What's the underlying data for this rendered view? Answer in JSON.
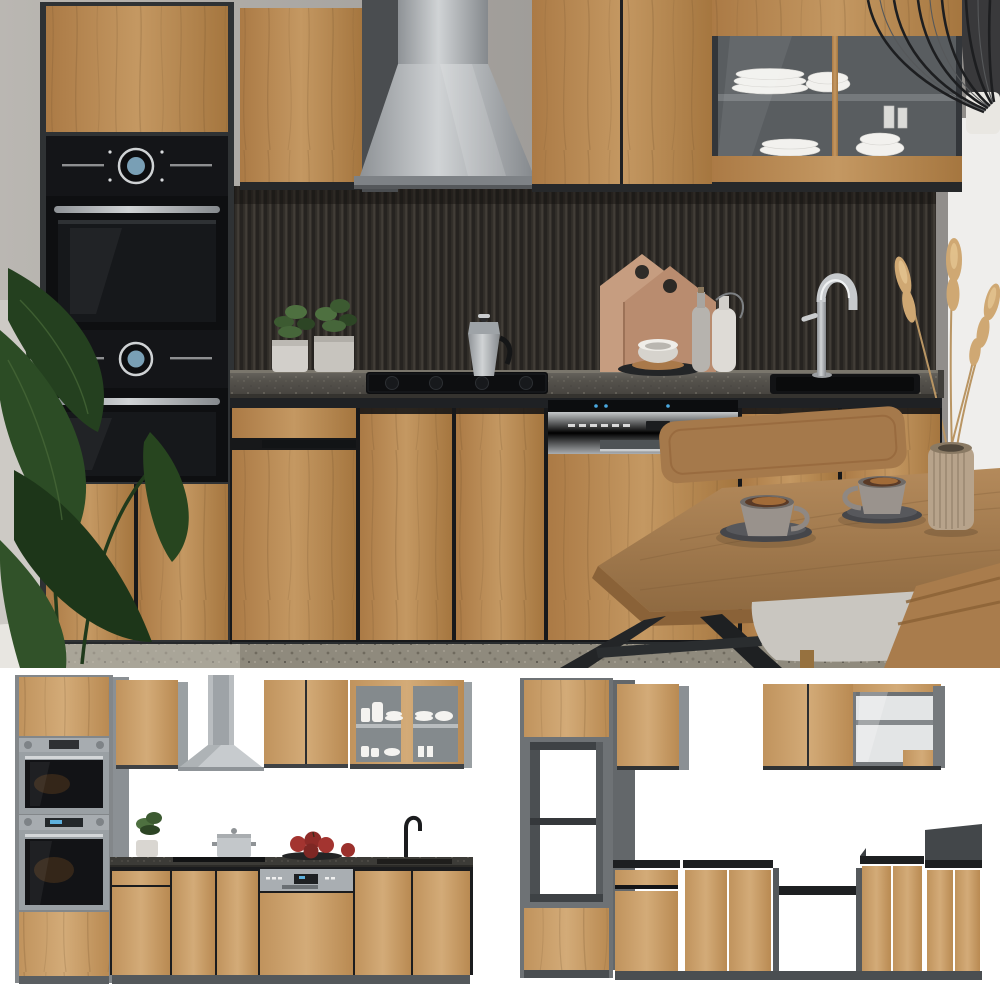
{
  "labels": {
    "page": "Product photo – modern oak and anthracite kitchenette set",
    "main_scene": "Kitchen scene: oak-front kitchenette with anthracite carcass, built-in double oven, chimney hood, glass display cabinet, dark fluted backsplash, sink and dining table",
    "thumb_front": "Front elevation render of the full kitchen set with appliances",
    "thumb_carcass": "Carcass render of the kitchen set without appliances (open niches)",
    "tall_cabinet": "Tall oven housing cabinet with stacked double oven",
    "wall_cabinets": "Oak wall cabinets",
    "range_hood": "Stainless steel chimney range hood",
    "glass_cabinet": "Glass display wall cabinet with white dishes",
    "pendant_lamp": "Black wire cage pendant lamp",
    "backsplash": "Dark fluted backsplash panel",
    "countertop": "Dark stone-effect countertop",
    "cooktop": "Black built-in cooktop with moka pot",
    "herb_pots": "Potted green herbs",
    "cutting_boards": "House-shaped wooden cutting boards",
    "bowl_tray": "Serving tray with bowl",
    "bottles": "Ceramic bottle and jug",
    "sink": "Black inset sink with chrome mixer tap",
    "dishwasher": "Semi-integrated dishwasher with stainless control panel",
    "base_cabinets": "Handleless oak base cabinets on anthracite plinth",
    "houseplant": "Large green houseplant",
    "pampas": "Dried pampas grass in ribbed vase",
    "dining_table": "Oak dining table with black metal legs",
    "chairs": "Wooden dining chairs with grey cushion",
    "coffee_cups": "Two espresso cups on saucers",
    "oven_stack_front": "Built-in microwave and oven (stainless frame)",
    "open_niche": "Open appliance niche in tall carcass"
  },
  "palette": {
    "wood": "#b5854e",
    "wood_light": "#c9a06a",
    "anthracite": "#2f3234",
    "plinth": "#43474a",
    "black_appliance": "#0e0f11",
    "steel": "#b5b9bc",
    "counter": "#56534d",
    "backsplash": "#35322d",
    "wall": "#a5a29e",
    "white_wall": "#efeeec",
    "floor": "#8f8a7d",
    "plant_green": "#2c4a26",
    "pampas_beige": "#c6a06b",
    "table_wood": "#a67c4e",
    "cushion_grey": "#c9c6c0",
    "apple_red": "#a33430",
    "led_blue": "#4aa8e0",
    "coffee_brown": "#5a3a26",
    "glass_grey": "#595d60"
  }
}
